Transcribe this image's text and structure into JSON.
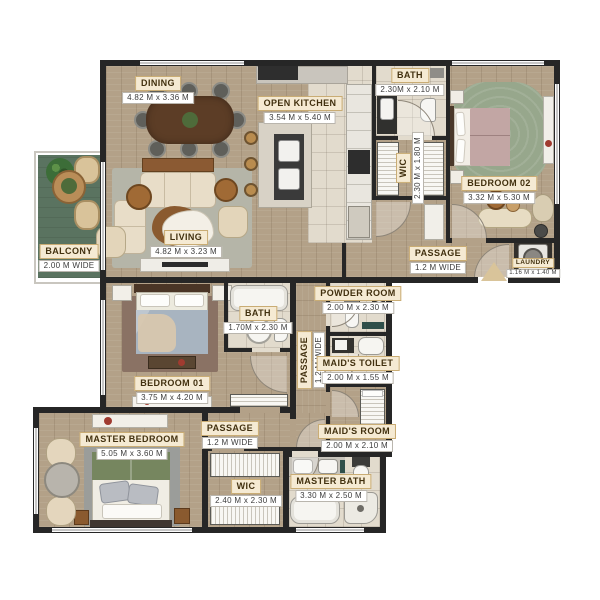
{
  "plan_title": "apartment-floor-plan",
  "palette": {
    "wall": "#262626",
    "wood": "#b3a188",
    "tile": "#e2dbcd",
    "balcony_green": "#5a7360",
    "label_bg": "#f5ead3",
    "label_border": "#c9ac74",
    "label_text": "#41300f",
    "rug_living": "#b5b5a8",
    "rug_bedroom02": "#97a78c",
    "rug_bedroom01": "#8a7264",
    "rug_master": "#9b9d9a",
    "bed_blue": "#a8b4c0",
    "bed_mauve": "#c2a6a4",
    "bed_green": "#76865f",
    "dark_wood": "#5c3d26",
    "accent_teal": "#2f4f4a"
  },
  "rooms": {
    "dining": {
      "name": "DINING",
      "dims": "4.82 M x 3.36 M"
    },
    "open_kitchen": {
      "name": "OPEN KITCHEN",
      "dims": "3.54 M x 5.40 M"
    },
    "bath_top": {
      "name": "BATH",
      "dims": "2.30M x 2.10 M"
    },
    "wic_top": {
      "name": "WIC",
      "dims": "2.30 M x 1.80 M"
    },
    "bedroom02": {
      "name": "BEDROOM 02",
      "dims": "3.32 M x 5.30 M"
    },
    "passage_top": {
      "name": "PASSAGE",
      "dims": "1.2 M WIDE"
    },
    "laundry": {
      "name": "LAUNDRY",
      "dims": "1.16 M x 1.40 M"
    },
    "balcony": {
      "name": "BALCONY",
      "dims": "2.00 M WIDE"
    },
    "living": {
      "name": "LIVING",
      "dims": "4.82 M x 3.23 M"
    },
    "bedroom01": {
      "name": "BEDROOM 01",
      "dims": "3.75 M x 4.20 M"
    },
    "bath_mid": {
      "name": "BATH",
      "dims": "1.70M x 2.30 M"
    },
    "powder_room": {
      "name": "POWDER ROOM",
      "dims": "2.00 M x 2.30 M"
    },
    "passage_vertical": {
      "name": "PASSAGE",
      "dims": "1.2 M WIDE"
    },
    "maids_toilet": {
      "name": "MAID'S TOILET",
      "dims": "2.00 M x 1.55 M"
    },
    "maids_room": {
      "name": "MAID'S ROOM",
      "dims": "2.00 M x 2.10 M"
    },
    "master_bedroom": {
      "name": "MASTER BEDROOM",
      "dims": "5.05 M x 3.60 M"
    },
    "passage_bottom": {
      "name": "PASSAGE",
      "dims": "1.2 M WIDE"
    },
    "wic_bottom": {
      "name": "WIC",
      "dims": "2.40 M x 2.30 M"
    },
    "master_bath": {
      "name": "MASTER BATH",
      "dims": "3.30 M x 2.50 M"
    }
  }
}
